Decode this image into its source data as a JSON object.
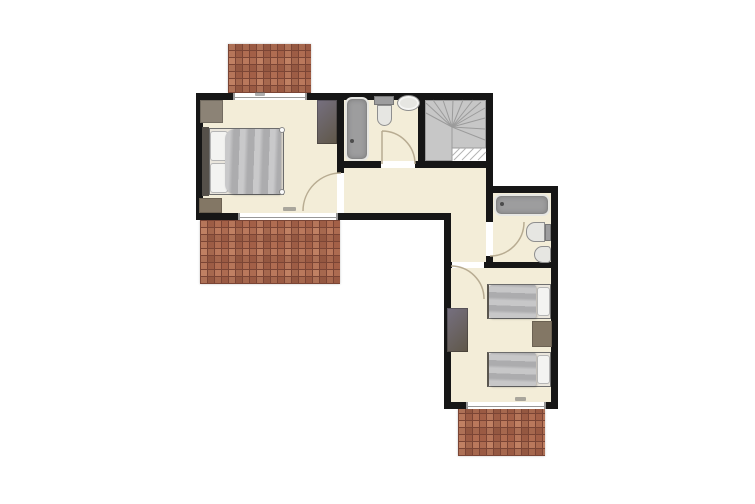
{
  "meta": {
    "title": "Upper floor plan",
    "visible_text": []
  },
  "palette": {
    "outside": "#ffffff",
    "wall": "#161616",
    "floor": "#f3edd8",
    "brick": "#ad6b52",
    "grout": "#7b4535",
    "stairs": "#c7c7c7",
    "stairline": "#9b9b9b",
    "hatchline": "#b3b3b3",
    "olive": "#767080",
    "olive-d": "#5f5748",
    "taupe": "#8c8376",
    "brownbox": "#837765",
    "bedframe": "#55504a",
    "mattress": "#eae6dd",
    "duvet": "#b7b7b9",
    "pillow": "#f3f3f1",
    "fixgray": "#9d9d9e",
    "fixlight": "#e6e6e2",
    "fixborder": "#8f8f8f",
    "doorarc": "#b8ac92",
    "windowline": "#979797",
    "dimmark": "#6b6b6b"
  },
  "legend": {
    "rooms": [
      "master-bedroom",
      "bathroom-top",
      "staircase",
      "hallway",
      "corridor",
      "bathroom-right",
      "twin-bedroom"
    ],
    "outdoor-areas": [
      "balcony-top",
      "terrace-bottom-left",
      "terrace-bottom-right"
    ],
    "furniture": [
      "double-bed",
      "wardrobe",
      "dresser-top-left",
      "chest-bottom-left",
      "twin-dresser",
      "nightstand",
      "single-bed-1",
      "single-bed-2"
    ],
    "fixtures": [
      "bathtub-top",
      "toilet-top",
      "sink-top",
      "bathtub-right",
      "toilet-right",
      "bidet-right"
    ],
    "symbols": [
      "door-swing-arc",
      "window-glazing",
      "stair-winders",
      "stair-void-hatch",
      "dimension-smudge"
    ]
  }
}
